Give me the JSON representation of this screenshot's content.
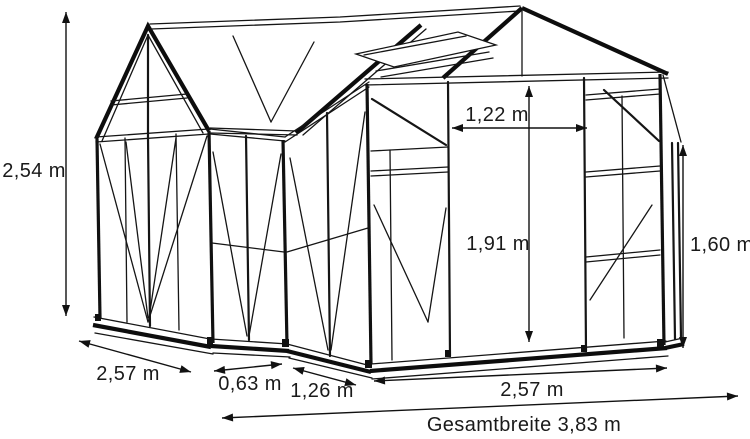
{
  "page": {
    "background": "#ffffff"
  },
  "diagram": {
    "subject": "Greenhouse dimension line drawing",
    "line_color": "#111111",
    "labels": {
      "height_left": "2,54 m",
      "door_width": "1,22 m",
      "door_height": "1,91 m",
      "eave_height_right": "1,60 m",
      "left_wing_front_width": "2,57 m",
      "front_section_small": "0,63 m",
      "side_return_width": "1,26 m",
      "main_front_width": "2,57 m",
      "total_width": "Gesamtbreite 3,83 m"
    }
  }
}
